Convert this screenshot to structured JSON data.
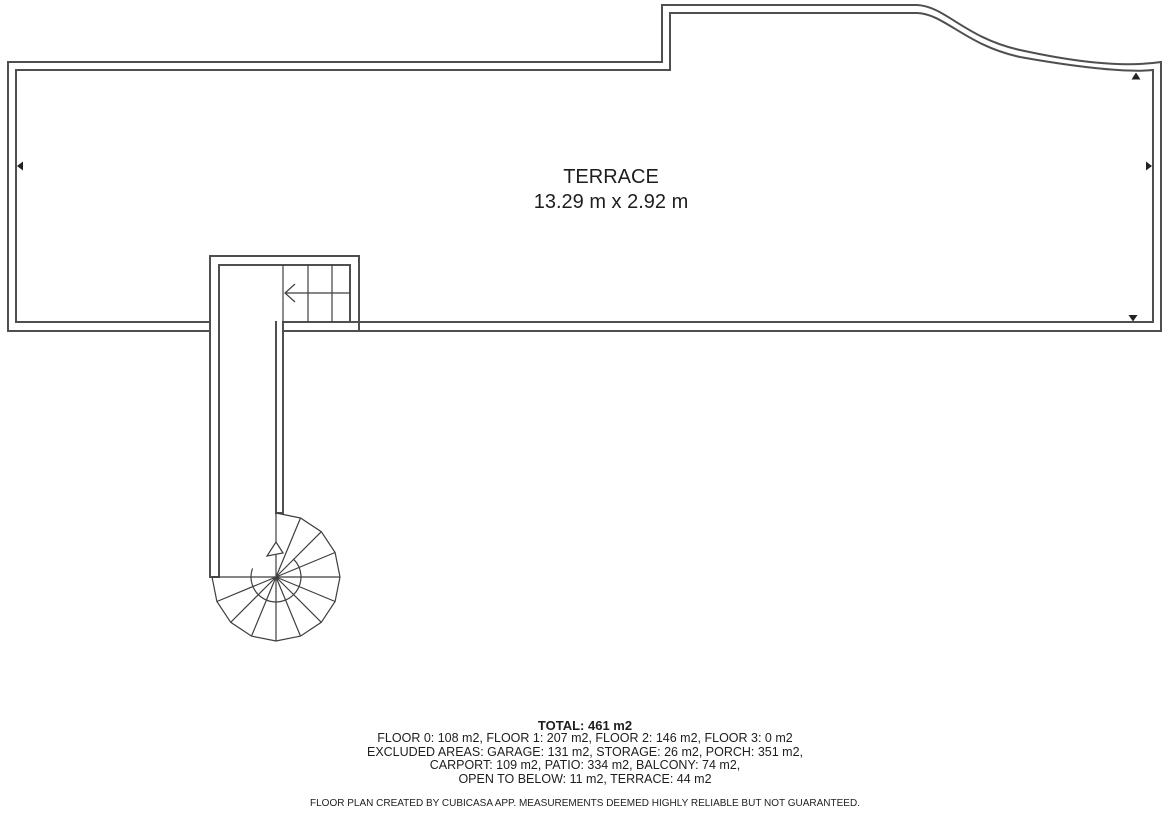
{
  "colors": {
    "wall": "#4f4f4f",
    "detail": "#3f3f3f",
    "marker": "#222222",
    "text": "#1e1e1e",
    "background": "#ffffff"
  },
  "floor_plan": {
    "room": {
      "name": "TERRACE",
      "dimensions": "13.29 m x 2.92 m"
    },
    "features": [
      "straight-stair-run",
      "spiral-staircase",
      "stairwell-shaft"
    ]
  },
  "icons": {
    "marker_left": "filled-triangle-left",
    "marker_right": "filled-triangle-right",
    "marker_up": "filled-triangle-up",
    "marker_down": "filled-triangle-down",
    "upper_stair_arrow": "open-arrowhead-left",
    "spiral_stair_arrow": "outline-arrowhead-up"
  },
  "summary": {
    "total": "TOTAL: 461 m2",
    "lines": [
      "FLOOR 0: 108 m2, FLOOR 1: 207 m2, FLOOR 2: 146 m2, FLOOR 3: 0 m2",
      "EXCLUDED AREAS: GARAGE: 131 m2, STORAGE: 26 m2, PORCH: 351 m2,",
      "CARPORT: 109 m2, PATIO: 334 m2, BALCONY: 74 m2,",
      "OPEN TO BELOW: 11 m2, TERRACE: 44 m2"
    ],
    "disclaimer": "FLOOR PLAN CREATED BY CUBICASA APP. MEASUREMENTS DEEMED HIGHLY RELIABLE BUT NOT GUARANTEED."
  }
}
